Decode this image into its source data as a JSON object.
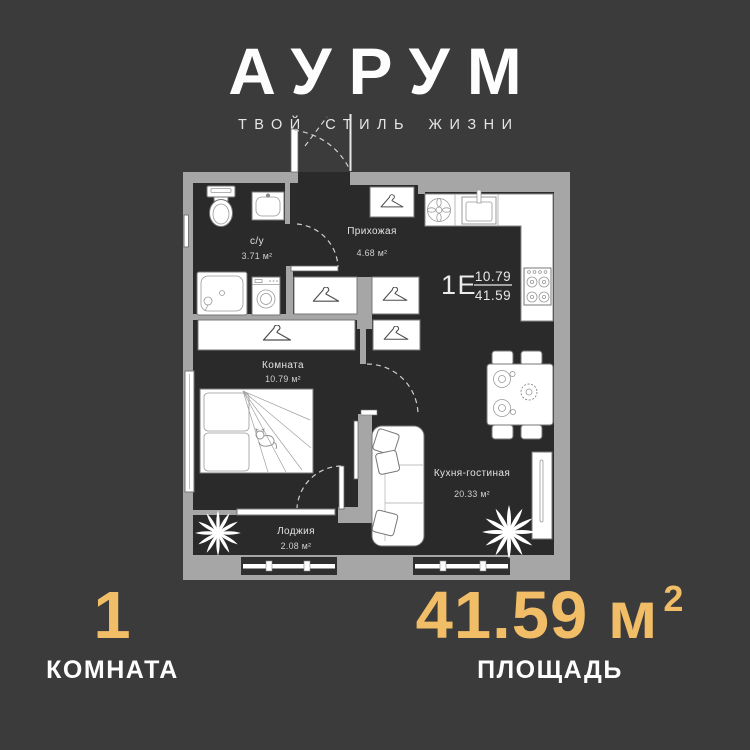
{
  "theme": {
    "background": "#3b3b3b",
    "interior": "#2a2a2a",
    "wall": "#a6a6a6",
    "gold": "#f2bd67"
  },
  "header": {
    "logo": "АУРУМ",
    "tagline": "ТВОЙ СТИЛЬ ЖИЗНИ"
  },
  "plan": {
    "unit": {
      "label": "1Е",
      "numerator": "10.79",
      "denominator": "41.59"
    },
    "rooms": {
      "bathroom": {
        "name": "с/у",
        "area": "3.71 м²"
      },
      "hallway": {
        "name": "Прихожая",
        "area": "4.68 м²"
      },
      "bedroom": {
        "name": "Комната",
        "area": "10.79 м²"
      },
      "kitchen": {
        "name": "Кухня-гостиная",
        "area": "20.33 м²"
      },
      "loggia": {
        "name": "Лоджия",
        "area": "2.08 м²"
      }
    }
  },
  "footer": {
    "rooms": {
      "value": "1",
      "label": "КОМНАТА"
    },
    "area": {
      "value": "41.59 м",
      "sup": "2",
      "label": "ПЛОЩАДЬ"
    }
  }
}
